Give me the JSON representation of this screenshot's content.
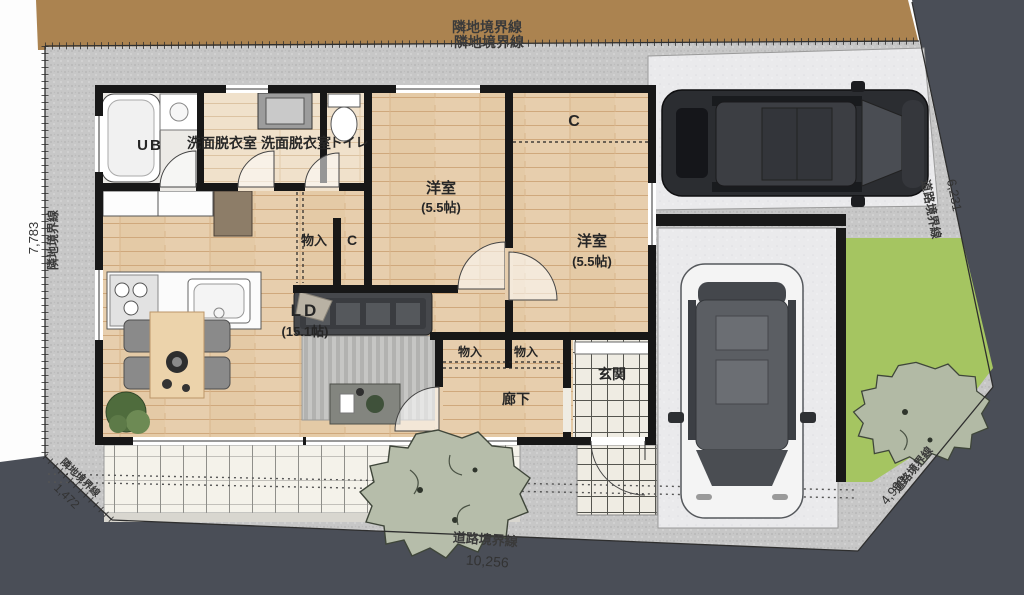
{
  "plan_title": "1F site / floor plan",
  "boundary": {
    "neighbor_top_1": "隣地境界線",
    "neighbor_top_2": "隣地境界線",
    "neighbor_left": "隣地境界線",
    "neighbor_corner": "隣地境界線",
    "road_bottom": "道路境界線",
    "road_right": "道路境界線",
    "road_corner": "道路境界線"
  },
  "dimensions": {
    "left": "7,783",
    "corner": "1,472",
    "bottom": "10,256",
    "right": "6,231",
    "corner_br": "4,999"
  },
  "rooms": {
    "ub": "UB",
    "washroom_a": "洗面脱衣室",
    "washroom_b": "洗面脱衣室",
    "toilet": "トイレ",
    "bedroom1": "洋室",
    "bedroom1_size": "(5.5帖)",
    "bedroom2": "洋室",
    "bedroom2_size": "(5.5帖)",
    "closet_top": "C",
    "closet_mid": "C",
    "storage_mid": "物入",
    "storage_hall_1": "物入",
    "storage_hall_2": "物入",
    "living": "LD",
    "living_size": "(15.1帖)",
    "hall": "廊下",
    "entry": "玄関"
  },
  "colors": {
    "neighbor_land": "#ab8350",
    "road": "#4a4e57",
    "lawn": "#a5c561",
    "gravel": "#c7c7c7",
    "wall": "#171717",
    "car_dark": "#2b2d31",
    "car_white": "#f4f4f4"
  }
}
